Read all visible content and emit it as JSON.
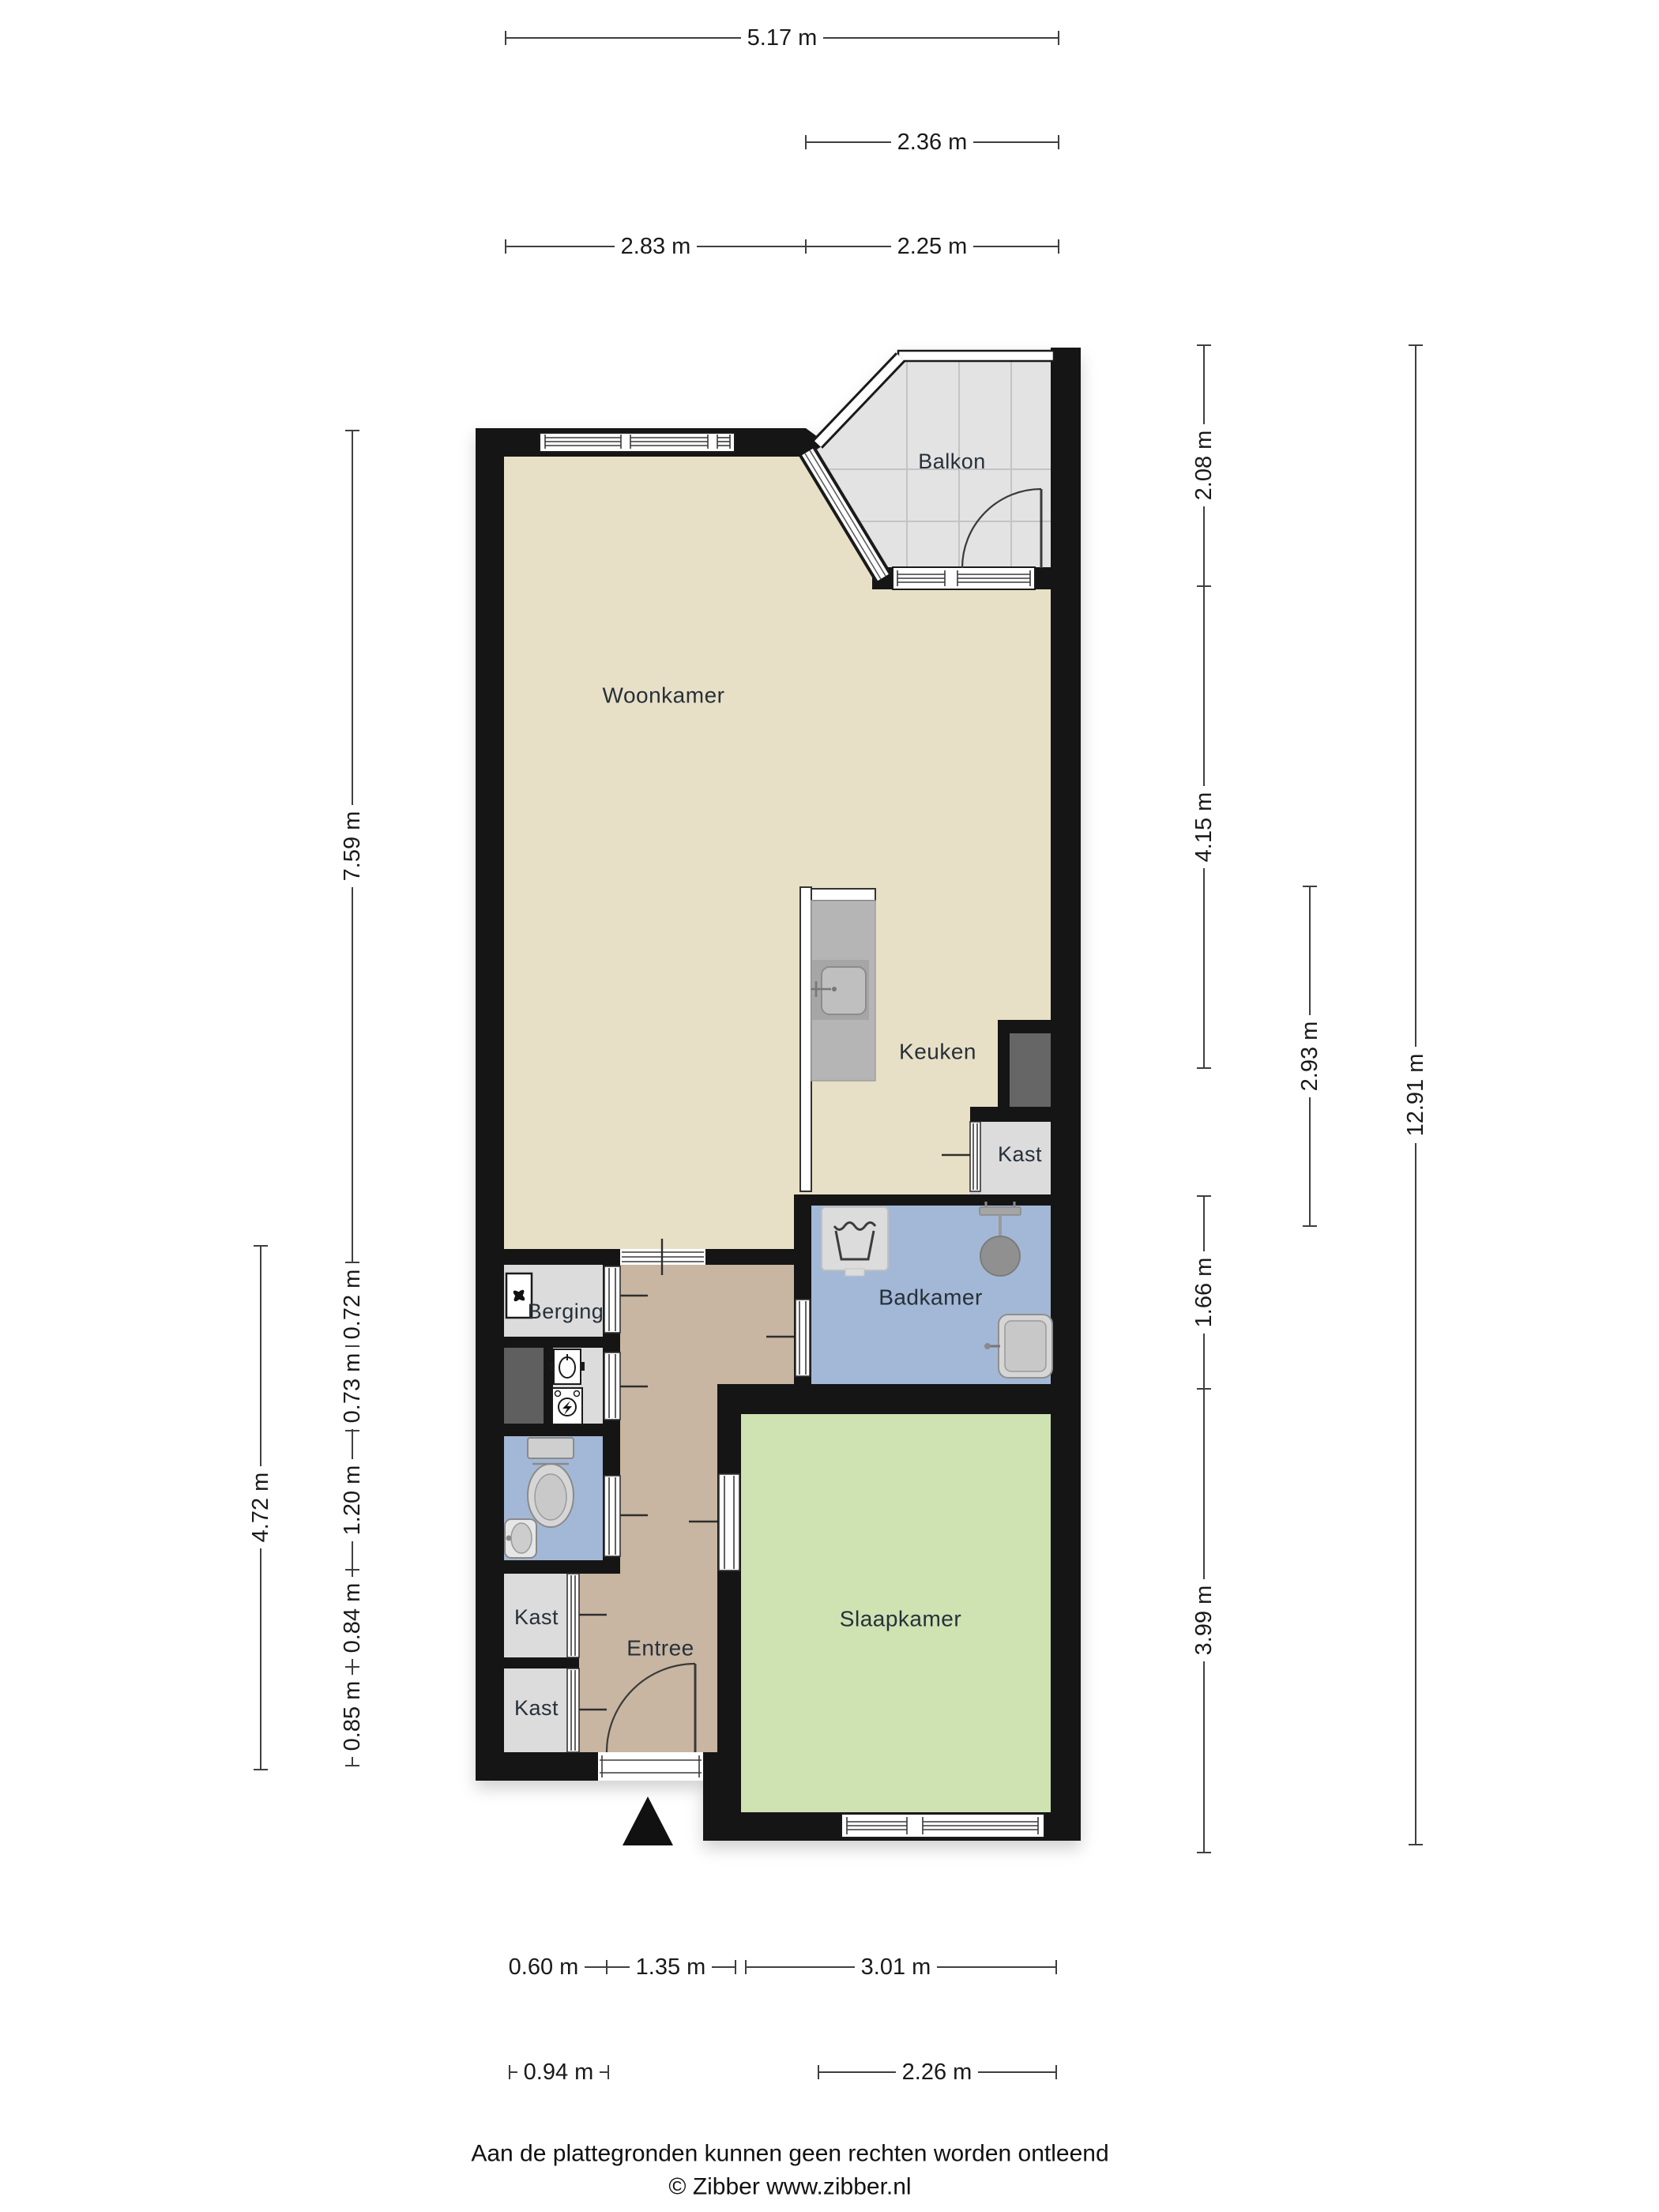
{
  "rooms": {
    "woonkamer": {
      "label": "Woonkamer"
    },
    "keuken": {
      "label": "Keuken"
    },
    "balkon": {
      "label": "Balkon"
    },
    "badkamer": {
      "label": "Badkamer"
    },
    "slaapkamer": {
      "label": "Slaapkamer"
    },
    "entree": {
      "label": "Entree"
    },
    "berging": {
      "label": "Berging"
    },
    "kast_bij_keuken": {
      "label": "Kast"
    },
    "kast_boven": {
      "label": "Kast"
    },
    "kast_onder": {
      "label": "Kast"
    }
  },
  "dimensions": {
    "top_total": "5.17 m",
    "top_balkon": "2.36 m",
    "top_left": "2.83 m",
    "top_right": "2.25 m",
    "left_woonkamer": "7.59 m",
    "left_s1": "0.72 m",
    "left_s2": "0.73 m",
    "left_s3": "1.20 m",
    "left_s4": "0.84 m",
    "left_s5": "0.85 m",
    "left_onder_totaal": "4.72 m",
    "right_balkon": "2.08 m",
    "right_woonkamer": "4.15 m",
    "right_keuken": "2.93 m",
    "right_badkamer": "1.66 m",
    "right_slaapkamer": "3.99 m",
    "right_total": "12.91 m",
    "bottom_kast": "0.60 m",
    "bottom_entree": "1.35 m",
    "bottom_slaapkamer": "3.01 m",
    "bottom_voordeur": "0.94 m",
    "bottom_raam": "2.26 m"
  },
  "footer": {
    "disclaimer": "Aan de plattegronden kunnen geen rechten worden ontleend",
    "credit": "© Zibber www.zibber.nl"
  },
  "colors": {
    "wall": "#151515",
    "woonkamer": "#e8e0c6",
    "entree": "#c8b6a2",
    "nat": "#a3b8d6",
    "slaapkamer": "#cfe2b2",
    "kast": "#dcdcdc",
    "balkon": "#e3e3e3",
    "schacht": "#5f5f5f"
  },
  "icons": {
    "washing_machine": "laundry-tub-glyph",
    "shower": "shower-head-with-mixer",
    "toilet": "toilet-tank-and-bowl",
    "bathroom_sink": "basin-glyph",
    "toilet_sink": "small-basin-glyph",
    "kitchen_sink": "counter-sink-glyph",
    "boiler": "fan-unit-glyph",
    "water_meter": "water-meter-glyph",
    "electricity_meter": "kwh-meter-glyph",
    "entrance_marker": "black-triangle-arrow"
  }
}
